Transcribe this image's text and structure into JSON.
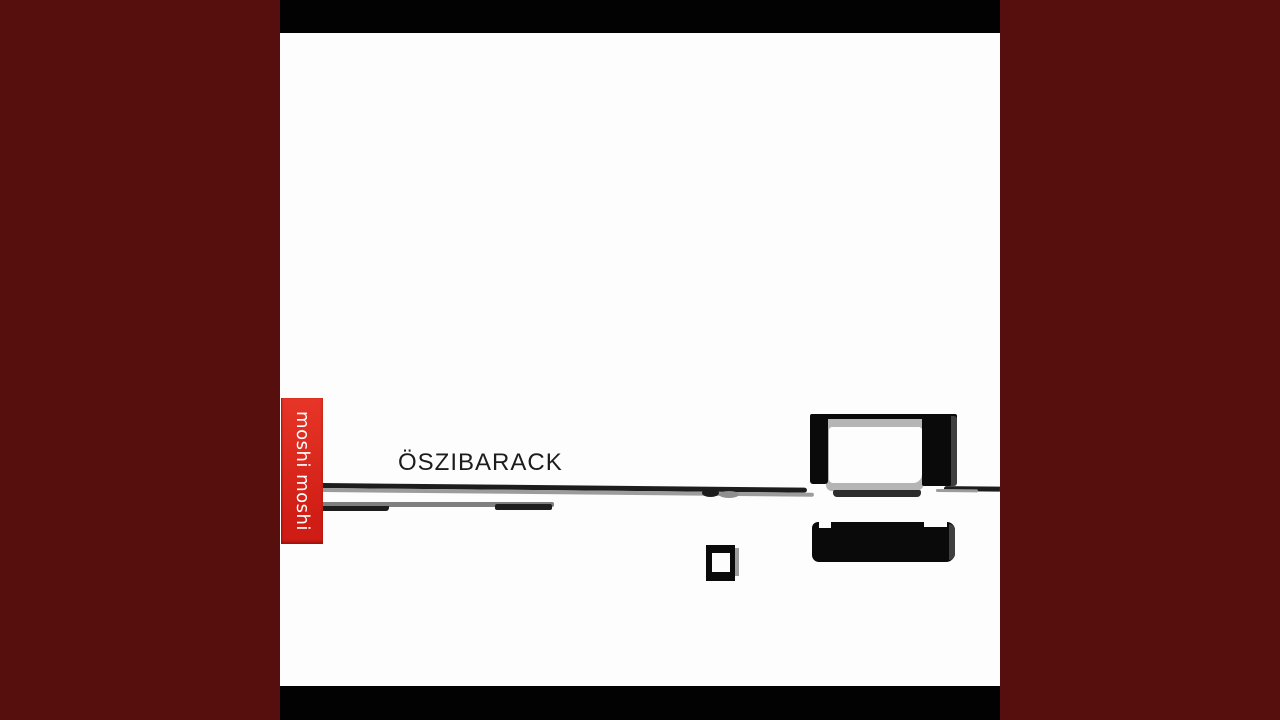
{
  "artwork": {
    "title": "ÖSZIBARACK",
    "label": "moshi moshi"
  },
  "colors": {
    "background": "#570f0d",
    "album_bar": "#020202",
    "album_white": "#fdfdfd",
    "badge_red_top": "#e73527",
    "badge_red_bottom": "#cf1d15",
    "badge_text": "#ffffff",
    "title_text": "#1c1c1c",
    "line_black": "#1d1d1d",
    "line_gray": "#9c9c9c",
    "line2_gray": "#7f7f7f",
    "blob_gray": "#8f8f8f",
    "shape_black": "#0a0a0a",
    "frame_gray": "#b5b5b5",
    "shadow_dark": "#2d2d2d",
    "edge_gray": "#3f3f3f",
    "square_shadow": "#9d9d9d"
  }
}
